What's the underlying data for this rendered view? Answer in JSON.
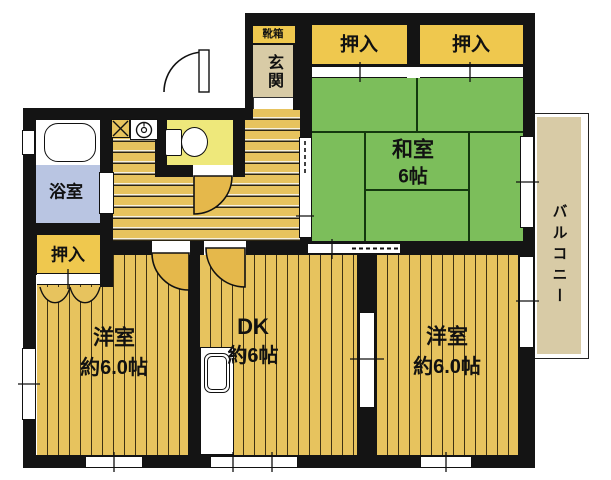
{
  "floor_plan": {
    "type": "apartment-floor-plan",
    "rooms": [
      {
        "id": "washitsu",
        "label": "和室",
        "size": "6帖"
      },
      {
        "id": "dining-kitchen",
        "label": "DK",
        "size": "約6帖"
      },
      {
        "id": "western-room-left",
        "label": "洋室",
        "size": "約6.0帖"
      },
      {
        "id": "western-room-right",
        "label": "洋室",
        "size": "約6.0帖"
      },
      {
        "id": "bathroom",
        "label": "浴室"
      },
      {
        "id": "entrance",
        "label": "玄関"
      },
      {
        "id": "shoe-cabinet",
        "label": "靴箱"
      },
      {
        "id": "balcony",
        "label": "バルコニー"
      }
    ],
    "closets": [
      {
        "id": "closet-top-left",
        "label": "押入"
      },
      {
        "id": "closet-top-right",
        "label": "押入"
      },
      {
        "id": "closet-bottom-left",
        "label": "押入"
      }
    ],
    "fixtures": [
      "bathtub-icon",
      "toilet-icon",
      "washing-machine-icon",
      "kitchen-sink-icon"
    ],
    "colors": {
      "flooring": "#e7c35e",
      "tatami": "#7cbe5b",
      "closet": "#efc84e",
      "bath": "#b9c5e2",
      "toilet_room": "#eee87b",
      "entrance_beige": "#d8cba6",
      "balcony_beige": "#d8cba6",
      "wall": "#141414"
    }
  }
}
